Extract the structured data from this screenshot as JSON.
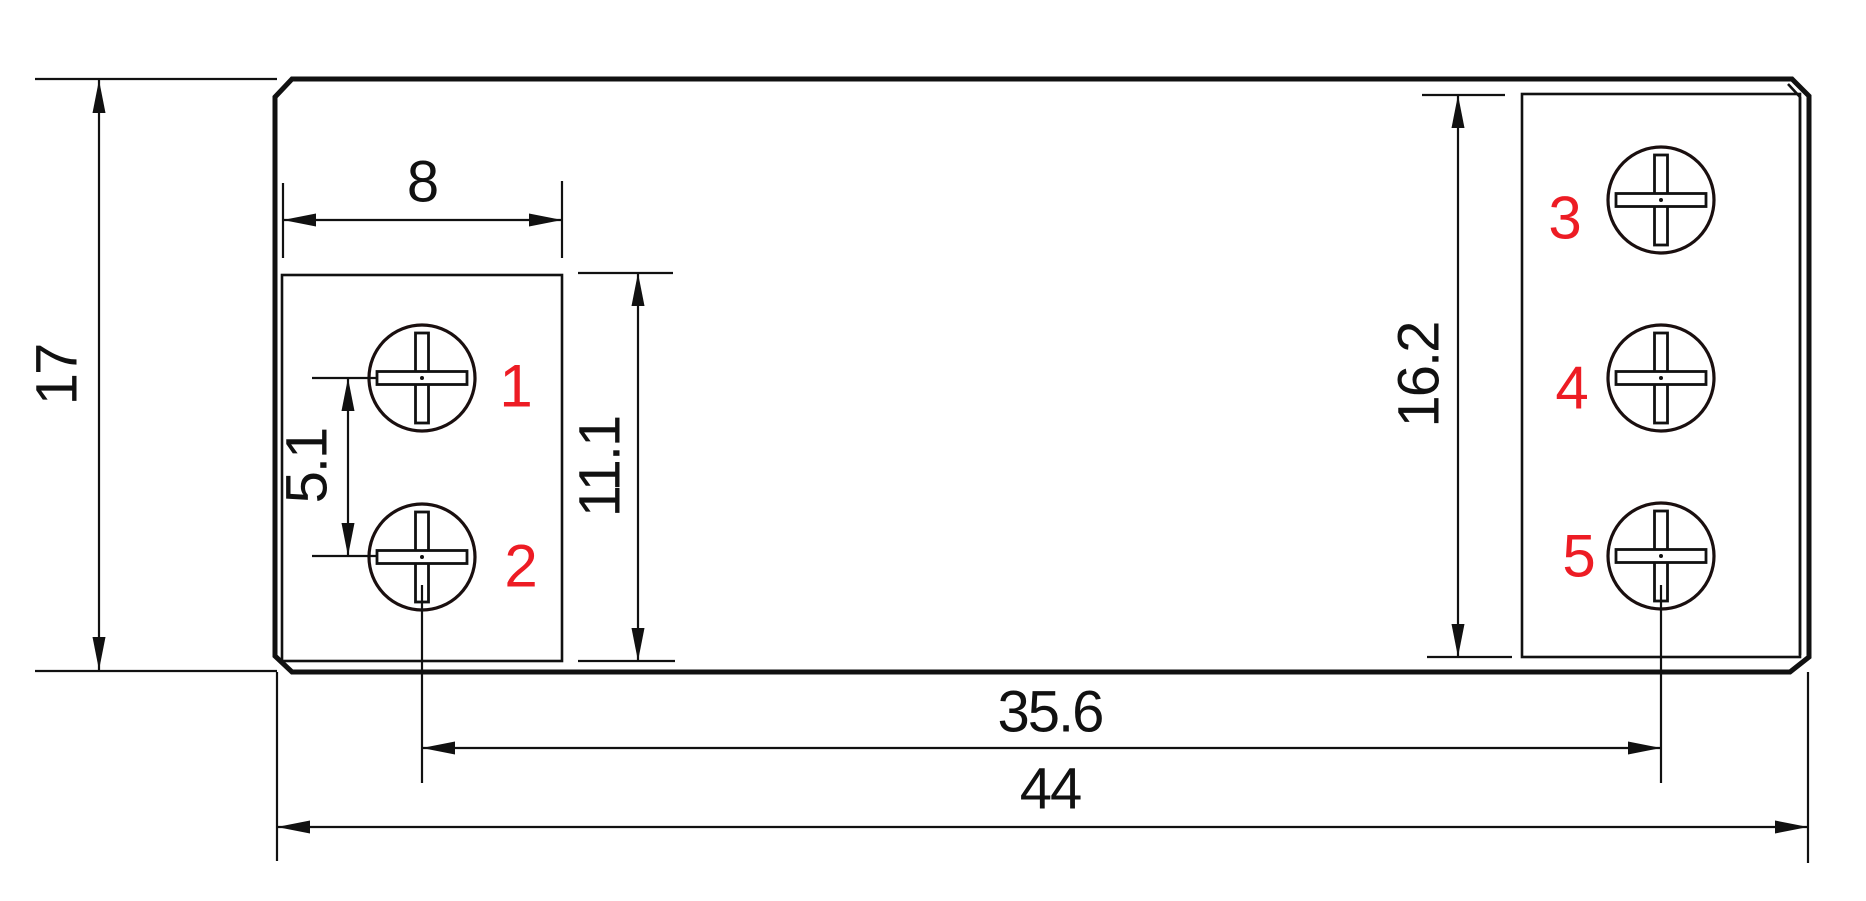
{
  "drawing": {
    "type": "mechanical-dimension-drawing",
    "colors": {
      "line": "#111111",
      "terminal_label": "#ed1c24",
      "background": "#ffffff"
    },
    "dimensions": {
      "overall_height": {
        "label": "17",
        "value": 17
      },
      "left_block_width": {
        "label": "8",
        "value": 8
      },
      "terminal_pitch": {
        "label": "5.1",
        "value": 5.1
      },
      "left_block_height": {
        "label": "11.1",
        "value": 11.1
      },
      "right_block_height": {
        "label": "16.2",
        "value": 16.2
      },
      "terminal_column_span": {
        "label": "35.6",
        "value": 35.6
      },
      "overall_width": {
        "label": "44",
        "value": 44
      }
    },
    "terminals": [
      {
        "id": "1"
      },
      {
        "id": "2"
      },
      {
        "id": "3"
      },
      {
        "id": "4"
      },
      {
        "id": "5"
      }
    ]
  }
}
